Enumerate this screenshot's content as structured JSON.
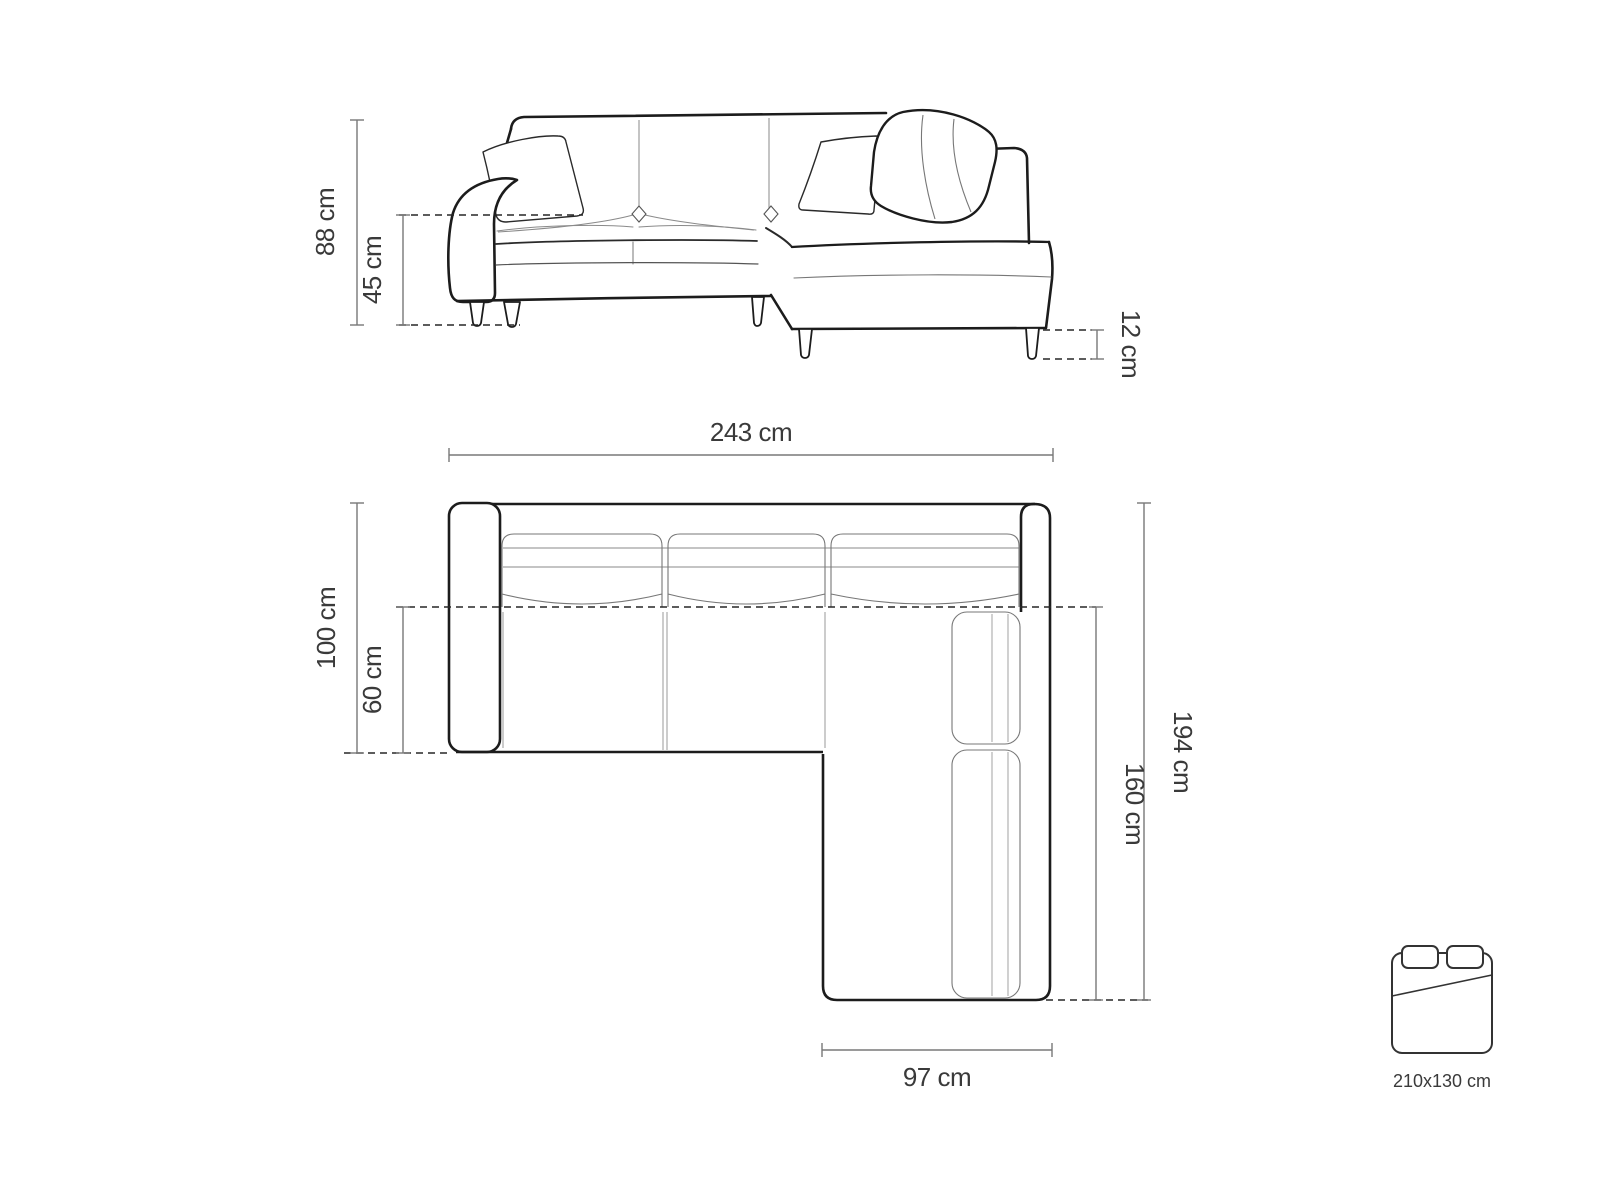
{
  "diagram": {
    "title": "corner-sofa-dimension-diagram",
    "front_view": {
      "height_label": "88 cm",
      "seat_height_label": "45 cm",
      "leg_height_label": "12 cm"
    },
    "top_view": {
      "width_label": "243 cm",
      "depth_label": "100 cm",
      "seat_depth_label": "60 cm",
      "total_length_label": "194 cm",
      "chaise_length_label": "160 cm",
      "chaise_width_label": "97 cm"
    },
    "sleeping_area": {
      "size_label": "210x130 cm"
    },
    "colors": {
      "background": "#ffffff",
      "outline": "#1c1c1c",
      "seam": "#8a8a8a",
      "dimension_line": "#787878",
      "dashed_line": "#262626",
      "text": "#3a3a3a"
    }
  }
}
